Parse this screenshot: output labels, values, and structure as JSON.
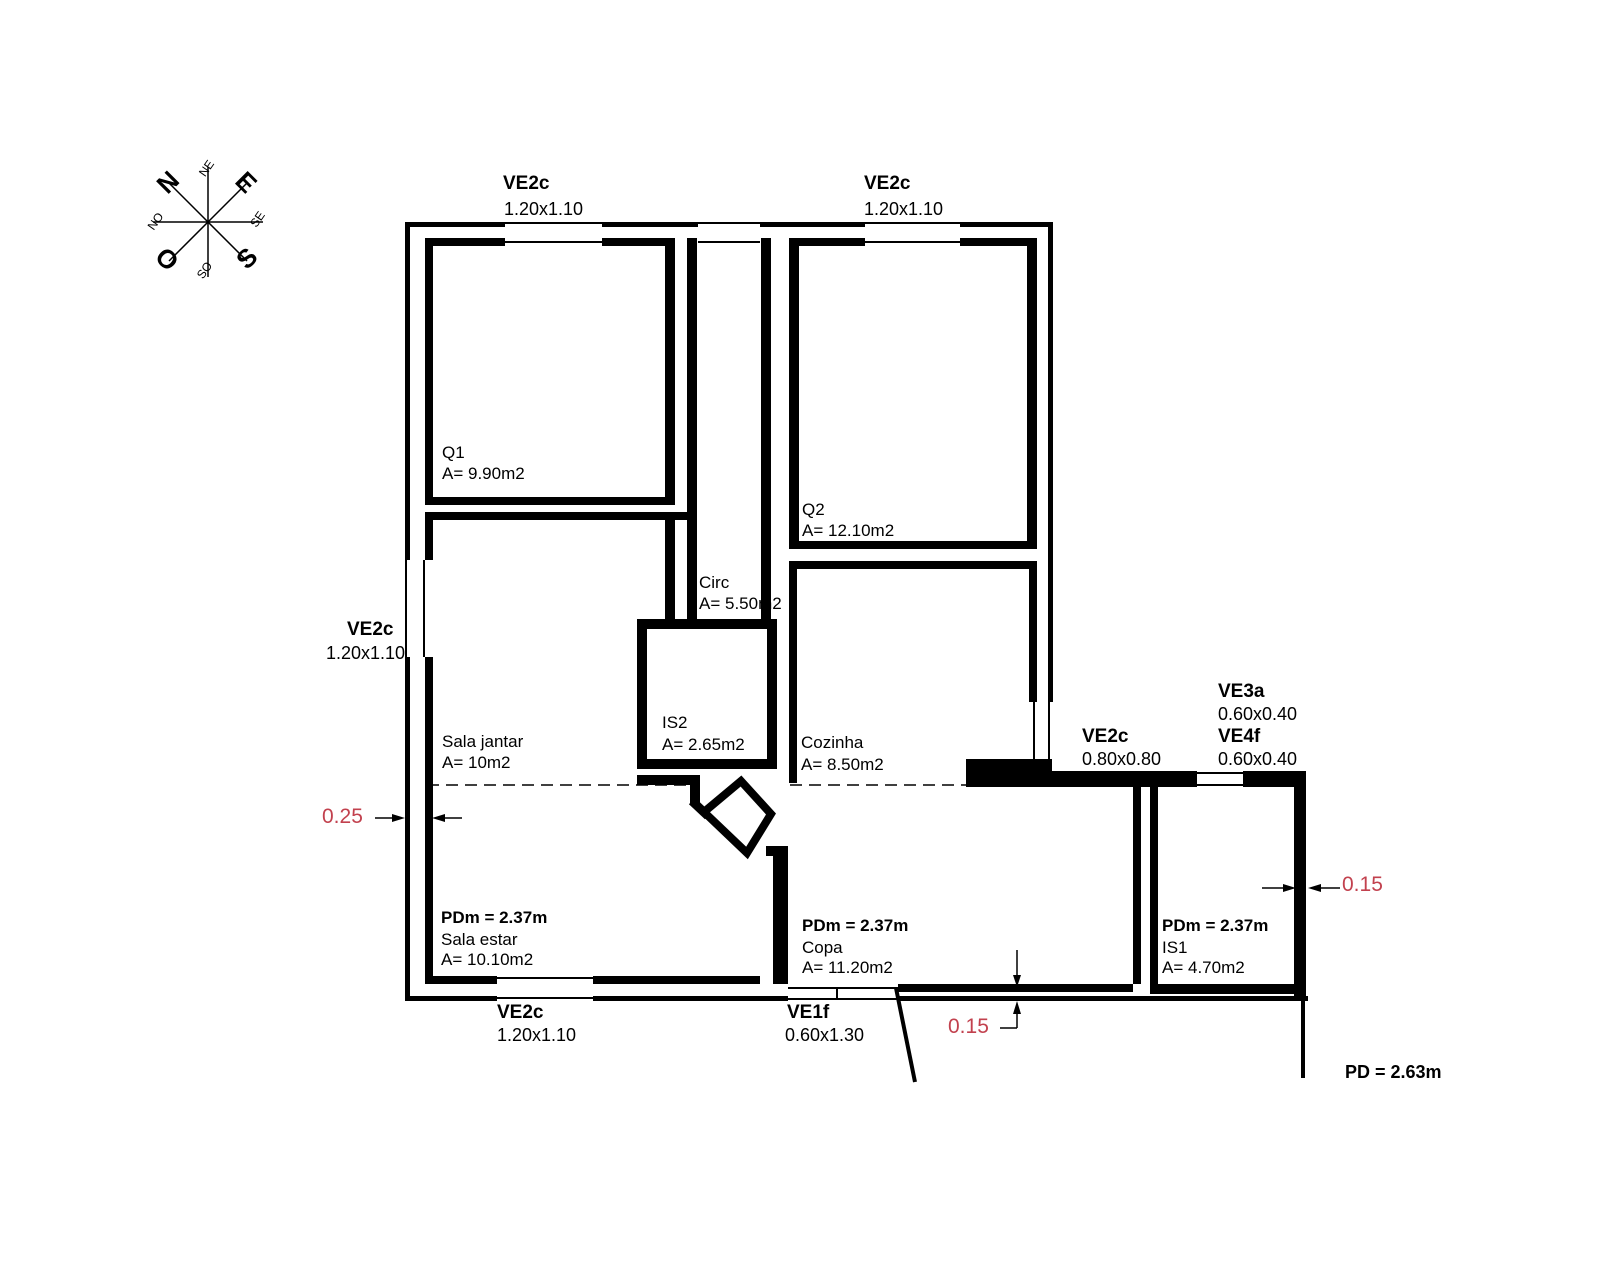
{
  "compass": {
    "n": "N",
    "e": "E",
    "s": "S",
    "o": "O",
    "ne": "NE",
    "se": "SE",
    "so": "SO",
    "no": "NO"
  },
  "windows": {
    "top_left": {
      "name": "VE2c",
      "size": "1.20x1.10"
    },
    "top_right": {
      "name": "VE2c",
      "size": "1.20x1.10"
    },
    "left": {
      "name": "VE2c",
      "size": "1.20x1.10"
    },
    "bottom": {
      "name": "VE2c",
      "size": "1.20x1.10"
    },
    "south_door": {
      "name": "VE1f",
      "size": "0.60x1.30"
    },
    "east": {
      "name": "VE2c",
      "size": "0.80x0.80"
    },
    "ve3a": {
      "name": "VE3a",
      "size": "0.60x0.40"
    },
    "ve4f": {
      "name": "VE4f",
      "size": "0.60x0.40"
    }
  },
  "rooms": {
    "q1": {
      "name": "Q1",
      "area": "A= 9.90m2"
    },
    "q2": {
      "name": "Q2",
      "area": "A= 12.10m2"
    },
    "circ": {
      "name": "Circ",
      "area": "A= 5.50m2"
    },
    "is2": {
      "name": "IS2",
      "area": "A= 2.65m2"
    },
    "cozinha": {
      "name": "Cozinha",
      "area": "A= 8.50m2"
    },
    "sala_jantar": {
      "name": "Sala jantar",
      "area": "A= 10m2"
    },
    "sala_estar": {
      "name": "Sala estar",
      "area": "A= 10.10m2",
      "pdm": "PDm = 2.37m"
    },
    "copa": {
      "name": "Copa",
      "area": "A= 11.20m2",
      "pdm": "PDm = 2.37m"
    },
    "is1": {
      "name": "IS1",
      "area": "A= 4.70m2",
      "pdm": "PDm = 2.37m"
    }
  },
  "dimensions": {
    "exterior_wall": "0.25",
    "bottom_wall": "0.15",
    "right_wall": "0.15",
    "ceiling_height": "PD = 2.63m"
  },
  "colors": {
    "line": "#000000",
    "dim_text": "#c2414e",
    "background": "#ffffff"
  }
}
